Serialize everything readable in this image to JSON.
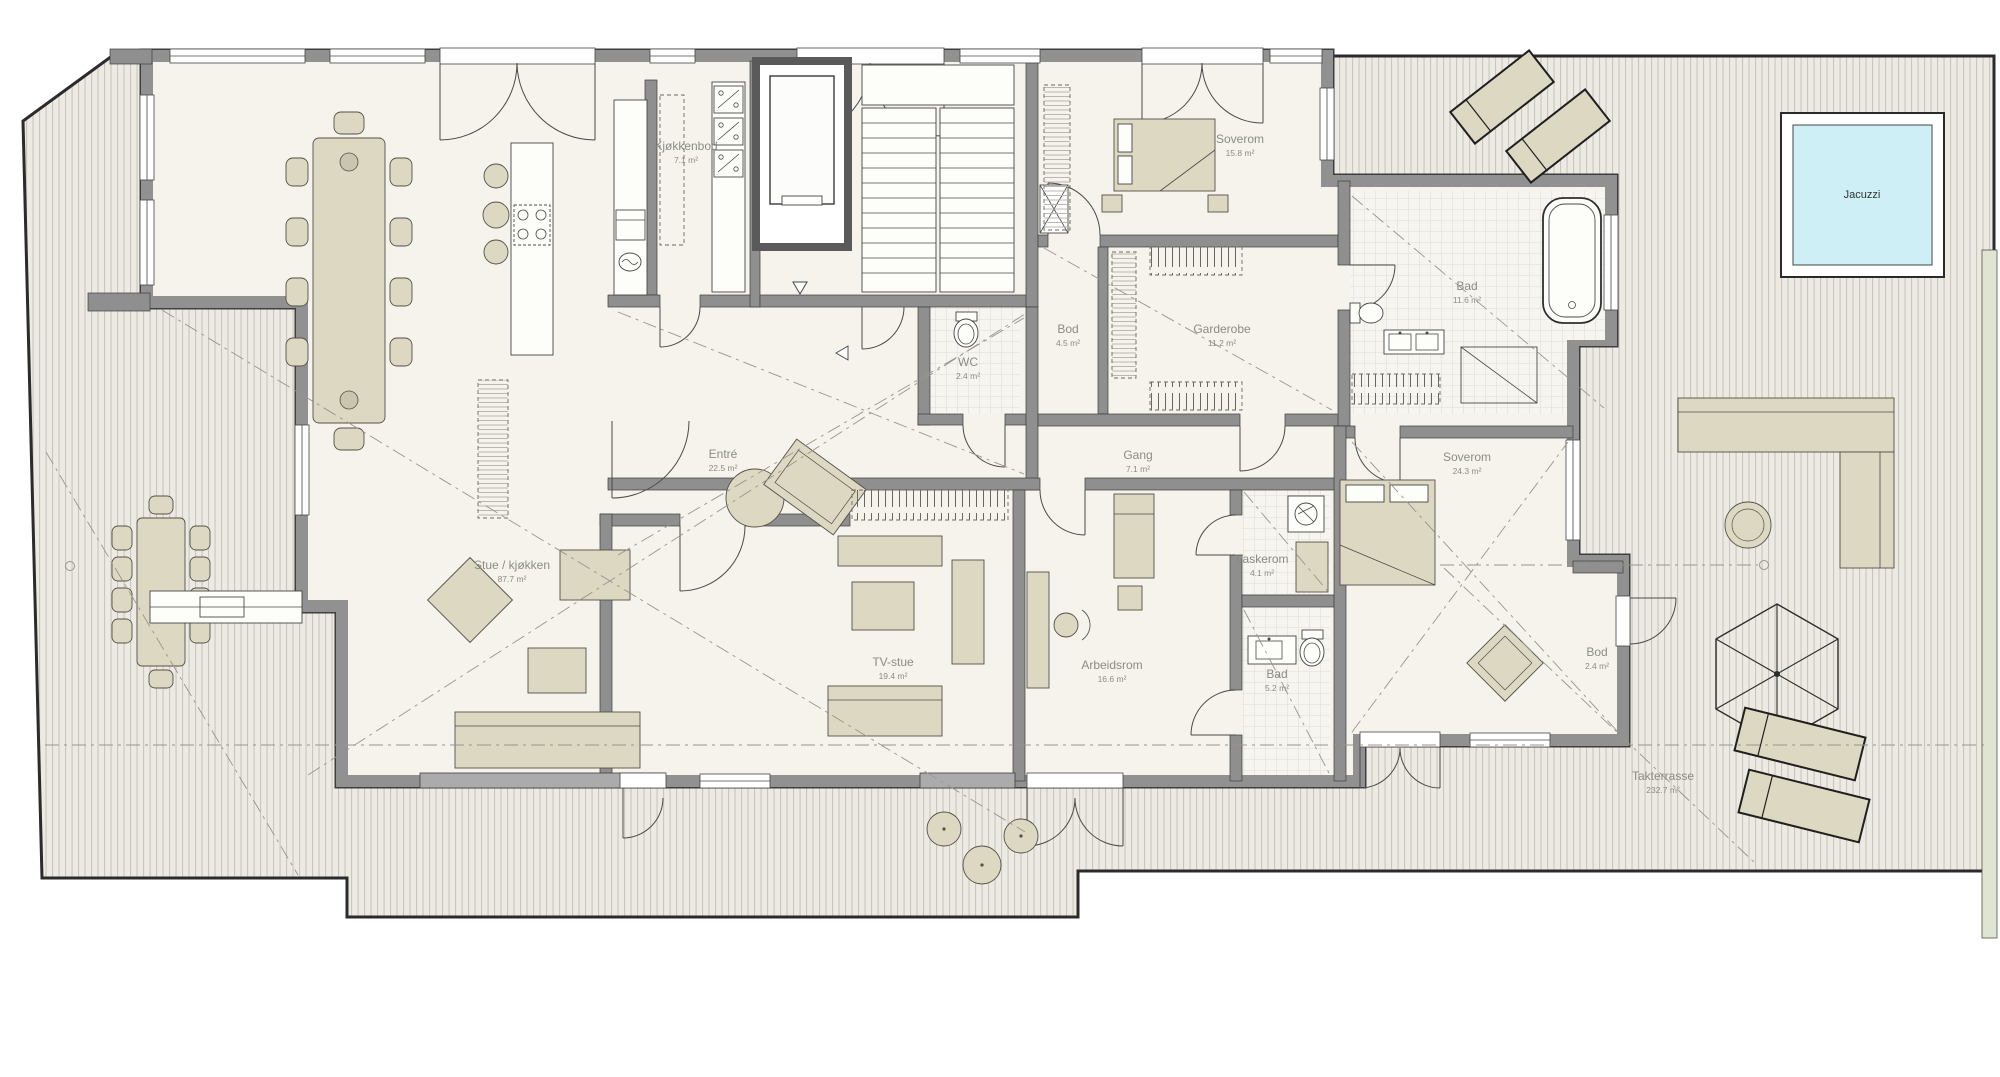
{
  "rooms": [
    {
      "name": "Kjøkkenbod",
      "area": "7.1 m²"
    },
    {
      "name": "Soverom",
      "area": "15.8 m²"
    },
    {
      "name": "Bad",
      "area": "11.6 m²"
    },
    {
      "name": "Bod",
      "area": "4.5 m²"
    },
    {
      "name": "Garderobe",
      "area": "11.2 m²"
    },
    {
      "name": "WC",
      "area": "2.4 m²"
    },
    {
      "name": "Entré",
      "area": "22.5 m²"
    },
    {
      "name": "Gang",
      "area": "7.1 m²"
    },
    {
      "name": "Soverom",
      "area": "24.3 m²"
    },
    {
      "name": "Stue / kjøkken",
      "area": "87.7 m²"
    },
    {
      "name": "Vaskerom",
      "area": "4.1 m²"
    },
    {
      "name": "TV-stue",
      "area": "19.4 m²"
    },
    {
      "name": "Arbeidsrom",
      "area": "16.6 m²"
    },
    {
      "name": "Bad",
      "area": "5.2 m²"
    },
    {
      "name": "Bod",
      "area": "2.4 m²"
    },
    {
      "name": "Takterrasse",
      "area": "232.7 m²"
    }
  ],
  "features": {
    "jacuzzi_label": "Jacuzzi"
  },
  "colors": {
    "deck_board_line": "#c9c6be",
    "deck_fill": "#eceae3",
    "apartment_floor": "#f5f3ec",
    "wall": "#8f8f8f",
    "furniture": "#ddd8c2",
    "jacuzzi_water": "#cdeff5",
    "label_gray": "#8c8c86",
    "planting_strip": "#dfe5d0"
  }
}
